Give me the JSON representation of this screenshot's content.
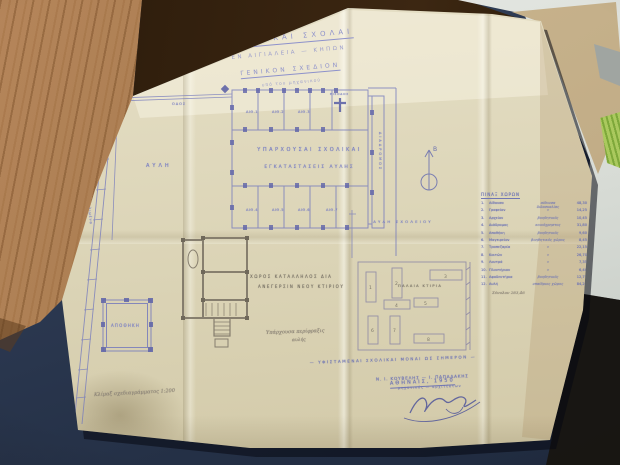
{
  "photo": {
    "colors": {
      "paper": "#ddd6b9",
      "blueprint_ink": "#7b80bf",
      "pencil": "#7e7667",
      "desk_wood": "#a87c50",
      "desk_mat_navy": "#2c3950",
      "manila_folder": "#c2ad87",
      "green_item": "#a3c353",
      "white_papers": "#dfe2dd"
    }
  },
  "blueprint": {
    "title": {
      "line1": "ΔΗΜΟΤΙΚΑΙ ΣΧΟΛΑΙ",
      "line2": "ΕΝ ΑΙΓΙΑΛΕΙΑ — ΚΗΠΩΝ",
      "line3": "ΓΕΝΙΚΟΝ ΣΧΕΔΙΟΝ",
      "line4": "υπό του μηχανικού"
    },
    "compass_label": "Β",
    "main_building": {
      "hall_line1": "ΥΠΑΡΧΟΥΣΑΙ ΣΧΟΛΙΚΑΙ",
      "hall_line2": "ΕΓΚΑΤΑΣΤΑΣΕΙΣ ΑΥΛΗΣ",
      "rooms_top": [
        "ΑΙΘ.1",
        "ΑΙΘ.2",
        "ΑΙΘ.3"
      ],
      "rooms_bottom": [
        "ΑΙΘ.4",
        "ΑΙΘ.5",
        "ΑΙΘ.6",
        "ΑΙΘ.7"
      ],
      "wing_label": "ΔΙΑΔΡΟΜΟΣ",
      "entrance_label": "ΕΙΣΟΔΟΣ"
    },
    "labels": {
      "courtyard": "ΑΥΛΗ",
      "street": "ΟΔΟΣ",
      "road_note": "οδός πρός λιμένα",
      "school_yard": "ΑΥΛΗ ΣΧΟΛΕΙΟΥ",
      "new_site_line1": "ΧΩΡΟΣ ΚΑΤΑΛΛΗΛΟΣ ΔΙΑ",
      "new_site_line2": "ΑΝΕΓΕΡΣΙΝ ΝΕΟΥ ΚΤΙΡΙΟΥ",
      "fence_note_line1": "Υπάρχουσα περίφραξις",
      "fence_note_line2": "αυλής",
      "old_buildings": "ΠΑΛΑΙΑ ΚΤΙΡΙΑ",
      "storage": "ΑΠΟΘΗΚΗ"
    },
    "site_numbers": [
      "1",
      "2",
      "3",
      "4",
      "5",
      "6",
      "7",
      "8"
    ],
    "table": {
      "header": "ΠΙΝΑΞ ΧΩΡΩΝ",
      "rows": [
        {
          "num": "1.",
          "name": "Αίθουσα",
          "desc": "αίθουσα διδασκαλίας",
          "value": "48,30"
        },
        {
          "num": "2.",
          "name": "Γραφείον",
          "desc": "»",
          "value": "14,25"
        },
        {
          "num": "3.",
          "name": "Αρχείον",
          "desc": "βοηθητικός",
          "value": "10,45"
        },
        {
          "num": "4.",
          "name": "Διάδρομος",
          "desc": "κοινόχρηστος",
          "value": "31,80"
        },
        {
          "num": "5.",
          "name": "Αποθήκη",
          "desc": "βοηθητικός",
          "value": "9,60"
        },
        {
          "num": "6.",
          "name": "Μαγειρείον",
          "desc": "βοηθητικός χώρος",
          "value": "8,45"
        },
        {
          "num": "7.",
          "name": "Τραπεζαρία",
          "desc": "»",
          "value": "22,15"
        },
        {
          "num": "8.",
          "name": "Κοιτών",
          "desc": "»",
          "value": "26,70"
        },
        {
          "num": "9.",
          "name": "Λουτρά",
          "desc": "»",
          "value": "7,35"
        },
        {
          "num": "10.",
          "name": "Πλυντήριον",
          "desc": "»",
          "value": "6,40"
        },
        {
          "num": "11.",
          "name": "Αφοδευτήρια",
          "desc": "βοηθητικός",
          "value": "12,75"
        },
        {
          "num": "12.",
          "name": "Αυλή",
          "desc": "υπαίθριος χώρος",
          "value": "84,25"
        }
      ],
      "total": "Σύνολον 283,46"
    },
    "footer": {
      "status_line": "— ΥΦΙΣΤΑΜΕΝΑΙ ΣΧΟΛΙΚΑΙ ΜΟΝΑΙ ΩΣ ΣΗΜΕΡΟΝ —",
      "place_date": "ΑΘΗΝΑΙΣ, 1950",
      "scale_note": "Κλίμαξ σχεδιαγράμματος 1:200",
      "names": "Ν. Ι. ΚΟΥΒΕΛΗΣ — Ι. ΠΑΠΑΔΑΚΗΣ",
      "roles": "μηχανικός — αρχιτέκτων"
    }
  }
}
